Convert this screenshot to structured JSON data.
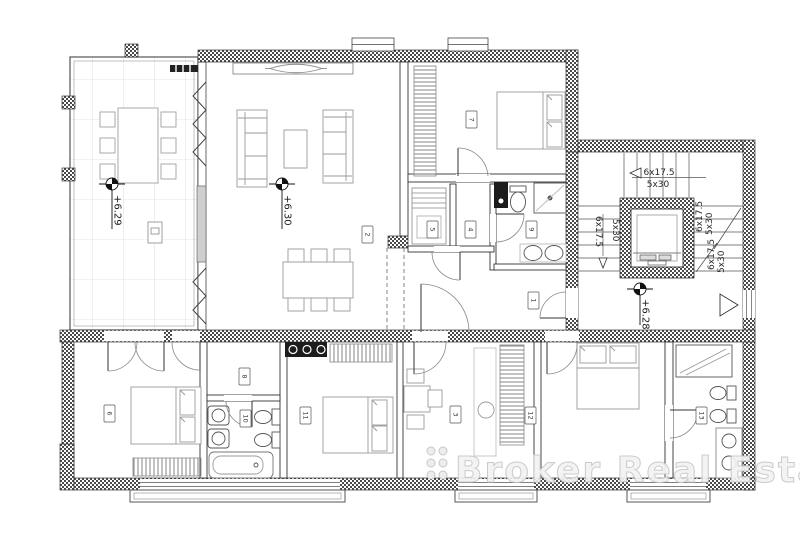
{
  "plan": {
    "levels": {
      "terrace": "+6.29",
      "living_room": "+6.30",
      "stairwell": "+6.28"
    },
    "stairs": {
      "flight_top": {
        "risers": "6x17.5",
        "treads": "5x30"
      },
      "flight_left": {
        "risers": "6x17.5",
        "treads": "5x30"
      },
      "flight_right_upper": {
        "risers": "6x17.5",
        "treads": "5x30"
      },
      "flight_right_lower": {
        "risers": "6x17.5",
        "treads": "5x30"
      }
    },
    "room_tags": [
      "1",
      "2",
      "3",
      "4",
      "5",
      "6",
      "7",
      "8",
      "9",
      "10",
      "11",
      "12",
      "13"
    ],
    "watermark": "Broker Real Estate",
    "colors": {
      "wall_hatch": "#4a4a4a",
      "line": "#333333",
      "watermark": "#d9d9d9"
    }
  }
}
